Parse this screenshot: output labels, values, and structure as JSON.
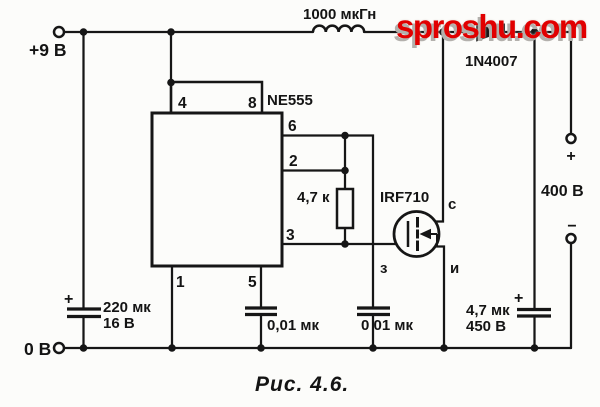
{
  "colors": {
    "ink": "#161616",
    "watermark_red": "#e10000",
    "paper": "#fcfcfa"
  },
  "watermark": {
    "text": "sproshu.com"
  },
  "caption": {
    "text": "Рис. 4.6."
  },
  "rails": {
    "positive": "+9 В",
    "ground": "0 В"
  },
  "inductor": {
    "value": "1000 мкГн"
  },
  "diode": {
    "part": "1N4007"
  },
  "ic": {
    "part": "NE555",
    "pin4": "4",
    "pin8": "8",
    "pin6": "6",
    "pin2": "2",
    "pin3": "3",
    "pin1": "1",
    "pin5": "5"
  },
  "resistor": {
    "value": "4,7 к"
  },
  "mosfet": {
    "part": "IRF710",
    "drain": "с",
    "gate": "з",
    "source": "и"
  },
  "cap_input": {
    "value": "220 мк",
    "voltage": "16 В",
    "plus": "+"
  },
  "cap_pin5": {
    "value": "0,01 мк"
  },
  "cap_timing": {
    "value": "0 01 мк"
  },
  "cap_output": {
    "value": "4,7 мк",
    "voltage": "450 В",
    "plus": "+"
  },
  "output": {
    "voltage": "400 В",
    "plus": "+",
    "minus": "−"
  }
}
